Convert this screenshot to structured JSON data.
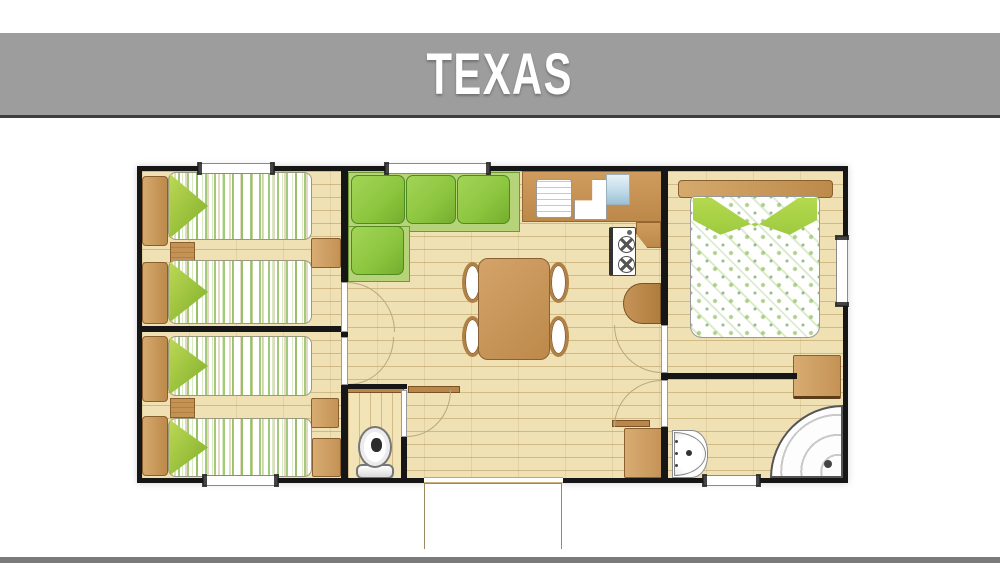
{
  "header": {
    "title": "TEXAS"
  },
  "palette": {
    "banner_bg": "#9d9d9d",
    "banner_edge": "#3f3f3f",
    "title_color": "#ffffff",
    "wall": "#161616",
    "floor": "#efe1b3",
    "floor_line": "#b49a66",
    "wood": "#c49255",
    "wood_dark": "#8a5f2e",
    "wood_light": "#d8ac72",
    "sofa_green": "#8bc53e",
    "sofa_green_dark": "#4e8a1d",
    "sofa_green_light": "#b7d379",
    "pillow_green": "#9cc93f",
    "glass_blue": "#bcd8e6",
    "arc_line": "#b9a87e",
    "porch_edge": "#9a8a60",
    "bottom_bar": "#7b7b7b"
  }
}
